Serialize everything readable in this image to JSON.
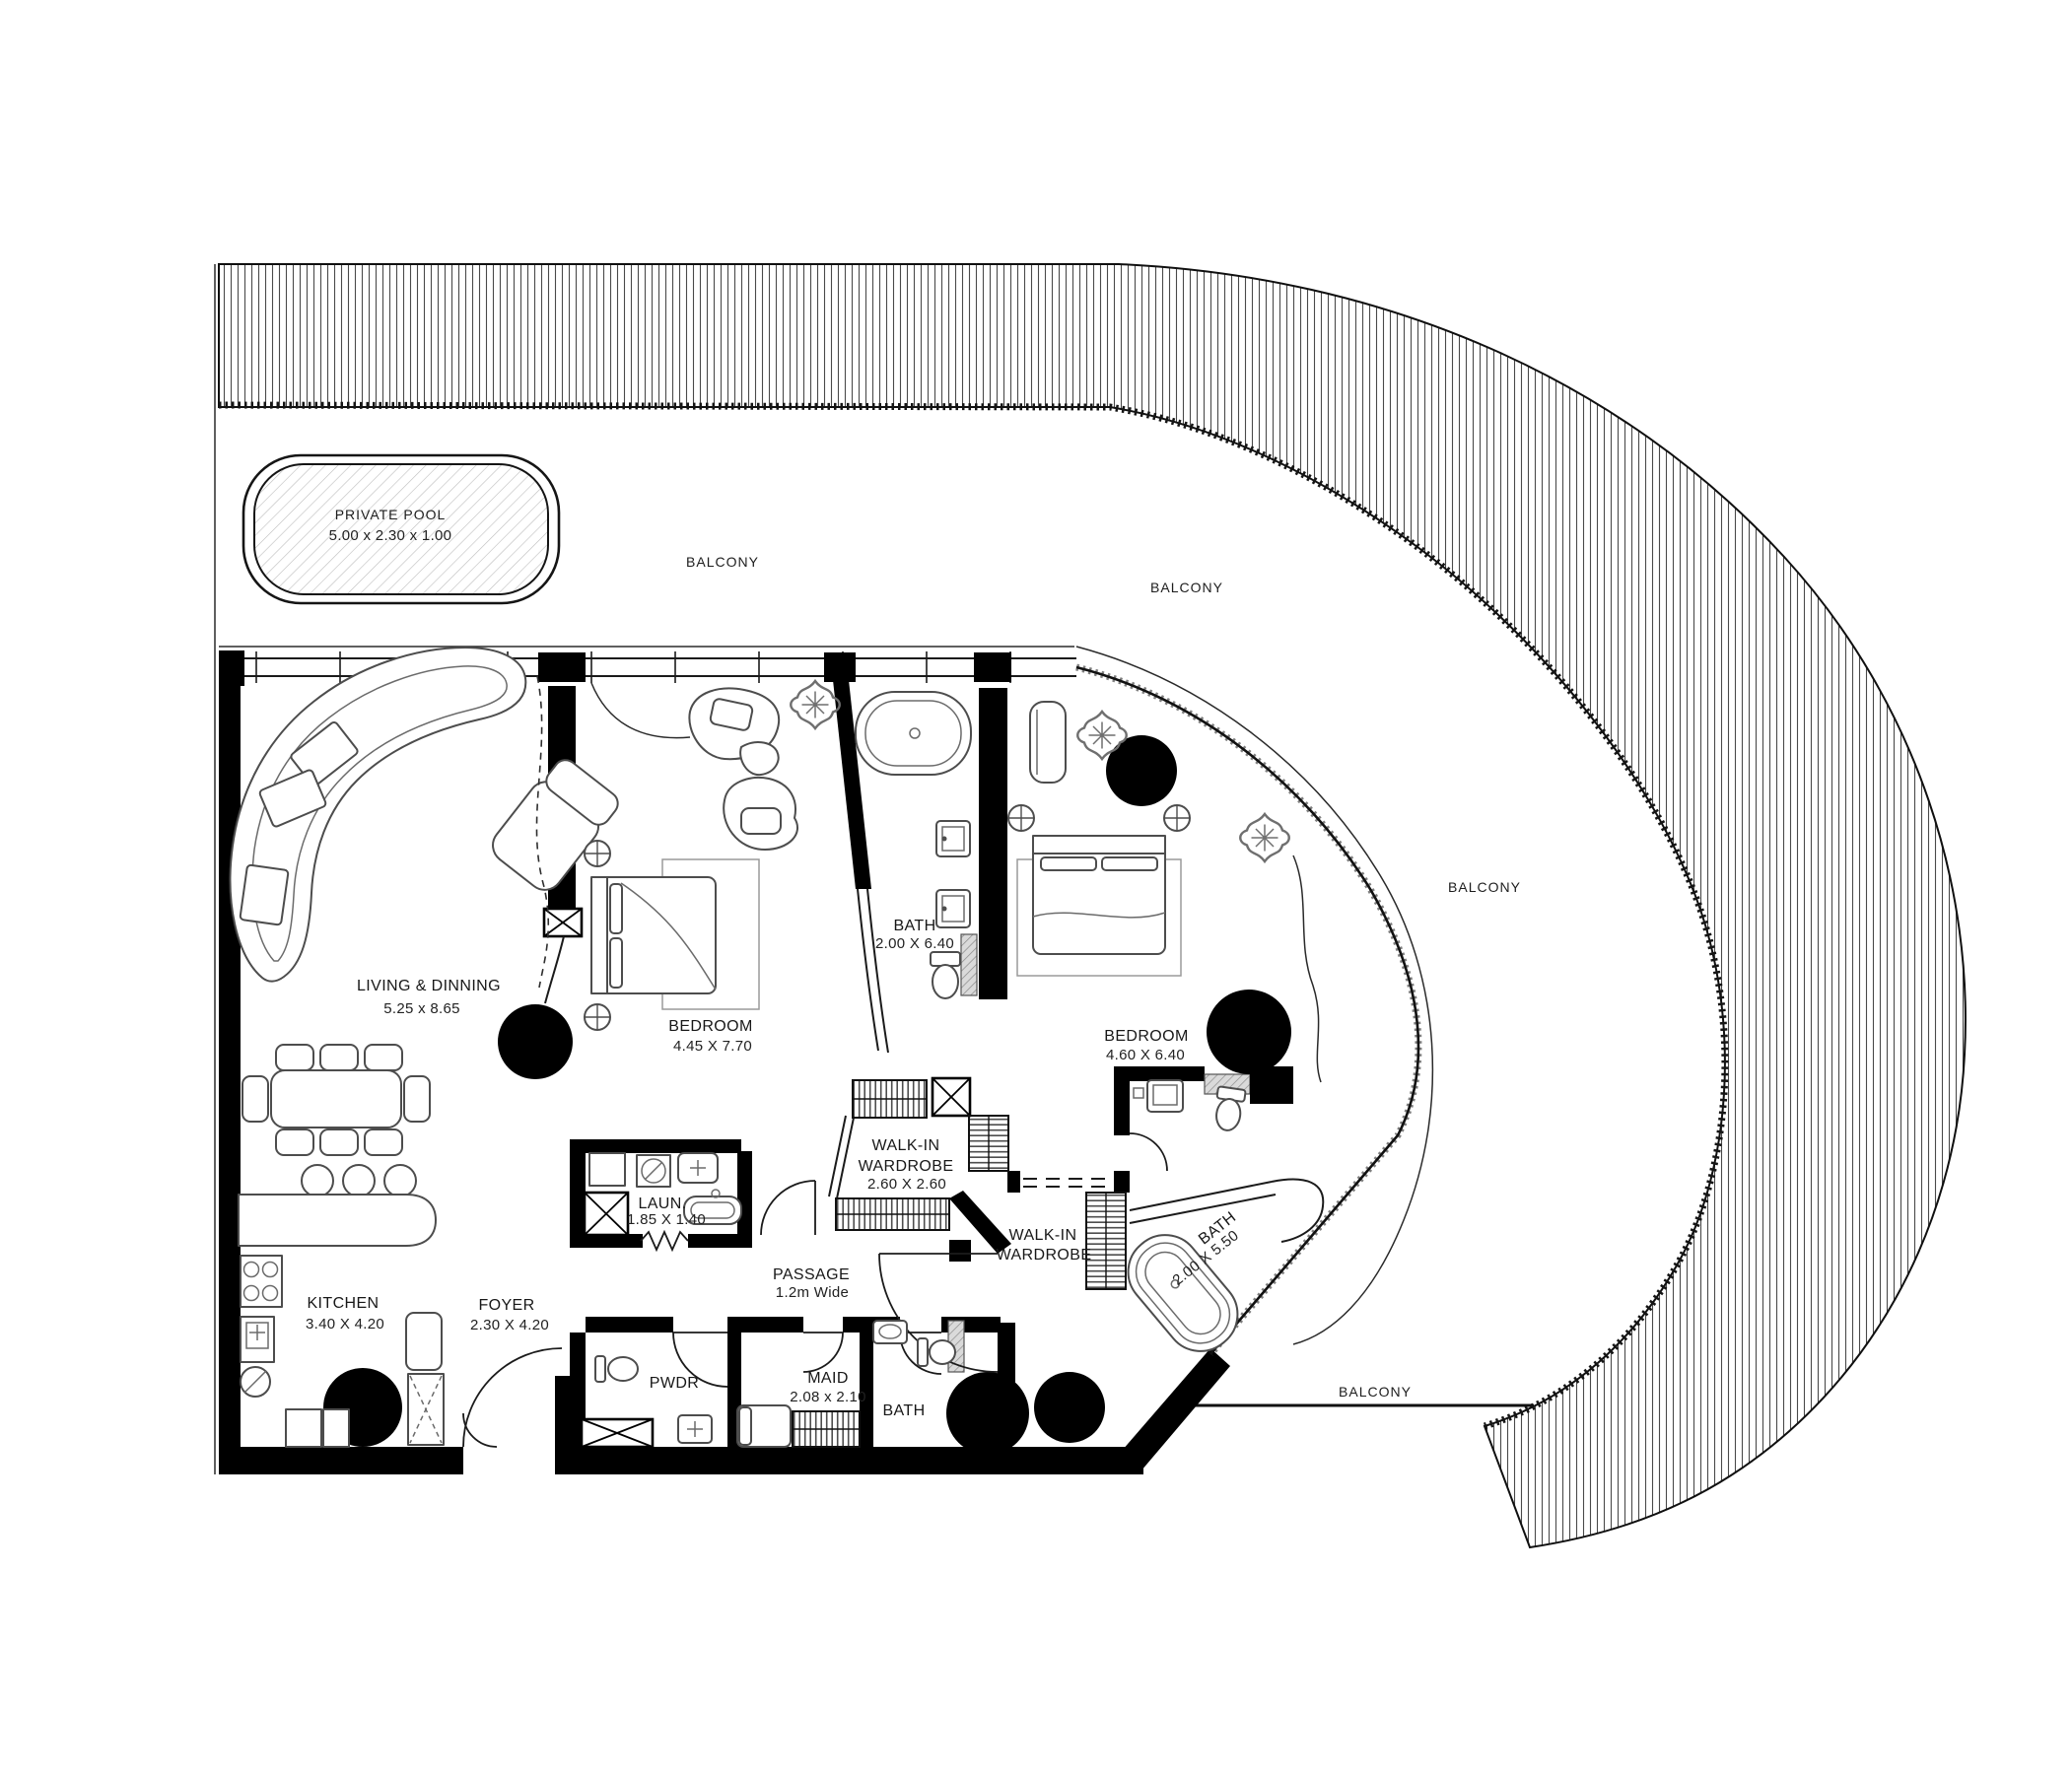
{
  "pool": {
    "name": "PRIVATE POOL",
    "dims": "5.00 x 2.30 x 1.00"
  },
  "balconies": {
    "top_left": "BALCONY",
    "top_right": "BALCONY",
    "right": "BALCONY",
    "bottom": "BALCONY"
  },
  "rooms": {
    "living": {
      "name": "LIVING & DINNING",
      "dims": "5.25 x 8.65"
    },
    "bedroom1": {
      "name": "BEDROOM",
      "dims": "4.45 X 7.70"
    },
    "bath1": {
      "name": "BATH",
      "dims": "2.00 X 6.40"
    },
    "bedroom2": {
      "name": "BEDROOM",
      "dims": "4.60 X 6.40"
    },
    "walkin1": {
      "line1": "WALK-IN",
      "line2": "WARDROBE",
      "dims": "2.60 X 2.60"
    },
    "walkin2": {
      "line1": "WALK-IN",
      "line2": "WARDROBE"
    },
    "laundry": {
      "name": "LAUN.",
      "dims": "1.85 X 1.40"
    },
    "passage": {
      "name": "PASSAGE",
      "dims": "1.2m Wide"
    },
    "kitchen": {
      "name": "KITCHEN",
      "dims": "3.40 X 4.20"
    },
    "foyer": {
      "name": "FOYER",
      "dims": "2.30 X 4.20"
    },
    "pwdr": {
      "name": "PWDR"
    },
    "maid": {
      "name": "MAID",
      "dims": "2.08 x 2.10"
    },
    "maid_bath": {
      "name": "BATH"
    },
    "bath2": {
      "name": "BATH",
      "dims": "2.00 X 5.50"
    }
  }
}
